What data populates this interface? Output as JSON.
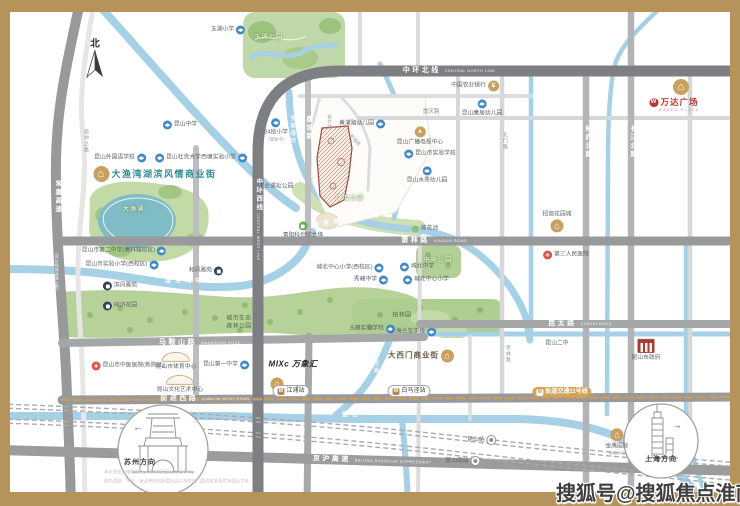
{
  "map": {
    "watermark": "搜狐号@搜狐焦点淮南站",
    "colors": {
      "frame_gold": "#b5935a",
      "ring_road": "#7e7f82",
      "road_gray": "#98999b",
      "road_light": "#bcbdbf",
      "river_blue": "#a6d0e6",
      "park_green": "#b9d49c",
      "lake_teal": "#7fbcc6",
      "poi_gold": "#c9a05e",
      "school_blue": "#4289c7",
      "hospital_red": "#d9534f",
      "residential_navy": "#33415c",
      "wanda_red": "#bf3330",
      "title_teal": "#2f8b94",
      "site_outline": "#a14a42",
      "metro_gold": "#c89c5e"
    },
    "labels": [
      {
        "t": "road",
        "n": "road-zhonghuan-north",
        "text": "中环北线",
        "sub": "CENTRAL NORTH LINE",
        "x": 449,
        "y": 71
      },
      {
        "t": "roadv",
        "n": "road-zhonghuan-west",
        "text": "中环西线",
        "x": 258,
        "y": 195
      },
      {
        "t": "roadv2",
        "n": "road-zhonghuan-west-en",
        "text": "CENTRAL WEST LINE",
        "x": 258,
        "y": 237
      },
      {
        "t": "road",
        "n": "road-xiaolin",
        "text": "萧林路",
        "sub": "XIAOLIN ROAD",
        "x": 434,
        "y": 241
      },
      {
        "t": "road",
        "n": "road-kuntai",
        "text": "昆太路",
        "sub": "KUNTAI ROAD",
        "x": 580,
        "y": 324
      },
      {
        "t": "road",
        "n": "road-maanshan",
        "text": "马鞍山路",
        "sub": "MAANSHAN ROAD",
        "x": 200,
        "y": 343
      },
      {
        "t": "road",
        "n": "road-qianjin-west",
        "text": "前进西路",
        "sub": "QIANJIN WEST ROAD",
        "x": 205,
        "y": 399
      },
      {
        "t": "road",
        "n": "road-jinghu-expressway",
        "text": "京沪高速",
        "sub": "BEIJING-SHANGHAI EXPRESSWAY",
        "x": 372,
        "y": 461,
        "rot": 1.6
      },
      {
        "t": "roadv",
        "n": "road-changjia-expressway",
        "text": "常嘉高速",
        "x": 57,
        "y": 197
      },
      {
        "t": "roadv2",
        "n": "road-changjia-sub",
        "text": "(苏州绕城高速公路)",
        "x": 57,
        "y": 272
      },
      {
        "t": "roadvg",
        "n": "road-zuchongzhi",
        "text": "祖冲之路",
        "x": 85,
        "y": 141
      },
      {
        "t": "roadv",
        "n": "road-lucheng",
        "text": "鹿城路",
        "x": 308,
        "y": 128
      },
      {
        "t": "roadv",
        "n": "road-bailu-north",
        "text": "柏庐北路",
        "x": 587,
        "y": 142
      },
      {
        "t": "roadv",
        "n": "road-changjiang-north",
        "text": "长江北路",
        "x": 632,
        "y": 142
      },
      {
        "t": "rdside",
        "n": "road-chongqing",
        "text": "重庆路",
        "x": 431,
        "y": 112
      },
      {
        "t": "roadvg",
        "n": "road-beimen",
        "text": "北门路",
        "x": 504,
        "y": 141
      },
      {
        "t": "roadvg",
        "n": "road-tinglin",
        "text": "亭林路",
        "x": 507,
        "y": 354
      },
      {
        "t": "riverv",
        "n": "river-zhangjiagang",
        "text": "张家港河",
        "x": 292,
        "y": 130
      },
      {
        "t": "river",
        "n": "river-eco-corridor",
        "text": "张家港河生态绿廊",
        "x": 353,
        "y": 220,
        "rot": -9
      },
      {
        "t": "river",
        "n": "river-miaojing-waterway",
        "text": "庙泾河中央水系",
        "x": 200,
        "y": 282
      },
      {
        "t": "river",
        "n": "river-loujiang",
        "text": "娄江",
        "x": 352,
        "y": 416
      },
      {
        "t": "riverv",
        "n": "river-qingyanggang",
        "text": "青阳港",
        "x": 375,
        "y": 364
      },
      {
        "t": "park",
        "n": "park-yuhu",
        "text": "玉湖公园",
        "x": 269,
        "y": 38
      },
      {
        "t": "park",
        "n": "lake-dayu",
        "text": "大渔湖",
        "x": 134,
        "y": 210
      },
      {
        "t": "parkd",
        "n": "park-forest-line1",
        "text": "城市生态",
        "x": 239,
        "y": 319
      },
      {
        "t": "parkd",
        "n": "park-forest-line2",
        "text": "森林公园",
        "x": 239,
        "y": 327
      },
      {
        "t": "park",
        "n": "park-central",
        "text": "中央公园",
        "x": 438,
        "y": 261
      },
      {
        "t": "parkd",
        "n": "park-bolin",
        "text": "柏林园",
        "x": 402,
        "y": 316
      },
      {
        "t": "park",
        "n": "park-guangdian",
        "text": "广电公园",
        "x": 350,
        "y": 199
      },
      {
        "t": "poi",
        "n": "poi-industrial-heritage-park",
        "text": "工业遗址公园",
        "x": 276,
        "y": 187
      },
      {
        "t": "poi",
        "n": "poi-lotus-pond",
        "text": "荷花池",
        "x": 425,
        "y": 229,
        "ic": "park-icon",
        "side": "b"
      },
      {
        "t": "title",
        "n": "title-dayuwan-street",
        "text": "大渔湾湖滨风情商业街",
        "x": 155,
        "y": 174,
        "ic": "gold-lg-icon",
        "side": "b"
      },
      {
        "t": "poi",
        "n": "poi-yuhu-primary",
        "text": "玉湖小学",
        "x": 228,
        "y": 30,
        "ic": "school-icon",
        "side": "a"
      },
      {
        "t": "poi",
        "n": "poi-kunshan-middle",
        "text": "昆山中学",
        "x": 180,
        "y": 125,
        "ic": "school-icon",
        "side": "b"
      },
      {
        "t": "poi",
        "n": "poi-foreign-language-school",
        "text": "昆山外国语学校",
        "x": 120,
        "y": 158,
        "ic": "school-icon",
        "side": "a"
      },
      {
        "t": "poi",
        "n": "poi-duke-kunshan-university",
        "text": "昆山杜克大学",
        "x": 178,
        "y": 158,
        "ic": "school-icon",
        "side": "b"
      },
      {
        "t": "poi",
        "n": "poi-xitang-experimental-primary",
        "text": "西塘实验小学",
        "x": 224,
        "y": 158,
        "ic": "school-icon",
        "side": "a"
      },
      {
        "t": "poist",
        "n": "poi-24class-primary",
        "text": "24班小学",
        "sub": "(规划中)",
        "x": 276,
        "y": 130,
        "ic": "school-icon"
      },
      {
        "t": "poi",
        "n": "poi-huangpu-kindergarten",
        "text": "黄浦路幼儿园",
        "x": 362,
        "y": 124,
        "ic": "school-icon",
        "side": "a"
      },
      {
        "t": "poi",
        "n": "poi-agricultural-bank",
        "text": "中国农业银行",
        "x": 475,
        "y": 86,
        "ic": "bank-icon",
        "side": "a"
      },
      {
        "t": "poist",
        "n": "poi-kangju-kindergarten",
        "text": "昆山康居幼儿园",
        "x": 482,
        "y": 108,
        "ic": "school-icon"
      },
      {
        "t": "poist",
        "n": "poi-broadcast-tv-center",
        "text": "昆山广播电视中心",
        "x": 420,
        "y": 136,
        "ic": "tower-gold-icon"
      },
      {
        "t": "poi",
        "n": "poi-kunshan-experimental-school",
        "text": "昆山市实验学校",
        "x": 430,
        "y": 154,
        "ic": "school-icon",
        "side": "b"
      },
      {
        "t": "poist",
        "n": "poi-shuixiu-kindergarten",
        "text": "昆山水秀幼儿园",
        "x": 427,
        "y": 175,
        "ic": "school-icon"
      },
      {
        "t": "poi",
        "n": "poi-chengbei-middle",
        "text": "城北中学",
        "x": 417,
        "y": 267,
        "ic": "school-icon",
        "side": "b"
      },
      {
        "t": "poi",
        "n": "poi-xiufeng-middle",
        "text": "秀峰中学",
        "x": 371,
        "y": 280,
        "ic": "school-icon",
        "side": "a"
      },
      {
        "t": "poi",
        "n": "poi-chengbei-central-primary",
        "text": "城北中心小学",
        "x": 426,
        "y": 280,
        "ic": "school-icon",
        "side": "b"
      },
      {
        "t": "poi",
        "n": "poi-chengbei-central-primary-west",
        "text": "城北中心小学(西校区)",
        "x": 350,
        "y": 268,
        "ic": "school-icon",
        "side": "a"
      },
      {
        "t": "poi",
        "n": "poi-yufeng-experimental-school",
        "text": "玉峰实验学校",
        "x": 372,
        "y": 329,
        "ic": "school-icon",
        "side": "a"
      },
      {
        "t": "poi",
        "n": "poi-no2-middle-xiaolin-campus",
        "text": "昆山市第二中学(萧林路校区)",
        "x": 124,
        "y": 251,
        "ic": "school-icon",
        "side": "a"
      },
      {
        "t": "poi",
        "n": "poi-experimental-primary-west-campus",
        "text": "昆山市实验小学(西校区)",
        "x": 122,
        "y": 265,
        "ic": "school-icon",
        "side": "a"
      },
      {
        "t": "poi",
        "n": "poi-hefeng-yayuan",
        "text": "和风雅苑",
        "x": 206,
        "y": 271,
        "ic": "res-icon",
        "side": "a"
      },
      {
        "t": "poi",
        "n": "poi-binfeng-yayuan",
        "text": "滨风雅苑",
        "x": 120,
        "y": 286,
        "ic": "res-icon",
        "side": "b"
      },
      {
        "t": "poi",
        "n": "poi-tongji-garden",
        "text": "同济花园",
        "x": 120,
        "y": 306,
        "ic": "res-icon",
        "side": "b"
      },
      {
        "t": "poist",
        "n": "poi-qingyang-tech-complex",
        "text": "青阳科创综合体",
        "x": 303,
        "y": 230,
        "ic": "green-icon"
      },
      {
        "t": "poi",
        "n": "poi-shanghai-lansheng-school",
        "text": "上海兰生学校",
        "x": 413,
        "y": 332,
        "ic": "school-icon",
        "side": "a"
      },
      {
        "t": "poi",
        "n": "poi-tcm-hospital-new-campus",
        "text": "昆山市中医医院(新院区)",
        "x": 128,
        "y": 366,
        "ic": "hospital-icon",
        "side": "b"
      },
      {
        "t": "poi",
        "n": "poi-third-peoples-hospital",
        "text": "第三人民医院",
        "x": 566,
        "y": 255,
        "ic": "hospital-icon",
        "side": "b"
      },
      {
        "t": "poisk",
        "n": "poi-sports-center",
        "text": "昆山市体育中心",
        "x": 176,
        "y": 361,
        "sk": true
      },
      {
        "t": "poisk",
        "n": "poi-culture-art-center",
        "text": "昆山文化艺术中心",
        "x": 180,
        "y": 384,
        "sk": true
      },
      {
        "t": "poi",
        "n": "poi-no1-middle-school",
        "text": "昆山第一中学",
        "x": 226,
        "y": 365,
        "ic": "school-icon",
        "side": "a"
      },
      {
        "t": "mixc",
        "n": "poi-mixc-logo",
        "text": "MIXc 万象汇",
        "x": 293,
        "y": 364
      },
      {
        "t": "iconly",
        "n": "poi-mixc-mall-icon",
        "x": 277,
        "y": 384,
        "ic": "shop-gold-icon"
      },
      {
        "t": "poilg",
        "n": "poi-daximen-commercial-street",
        "text": "大西门商业街",
        "x": 421,
        "y": 356,
        "ic": "shop-gold-icon",
        "side": "a"
      },
      {
        "t": "poistb",
        "n": "poi-cmsk-garden-city",
        "text": "招商花园城",
        "x": 557,
        "y": 222,
        "ic": "shop-gold-icon",
        "side": "a"
      },
      {
        "t": "poist",
        "n": "poi-golden-eagle-mall",
        "text": "金鹰国际",
        "sub": "购物中心",
        "x": 617,
        "y": 442,
        "ic": "shop-gold-icon"
      },
      {
        "t": "poist",
        "n": "poi-city-government",
        "text": "昆山市政府",
        "x": 646,
        "y": 350,
        "ic": "govt-icon"
      },
      {
        "t": "poi",
        "n": "poi-kunshan-no2-middle",
        "text": "昆山二中",
        "x": 557,
        "y": 344
      },
      {
        "t": "badge",
        "n": "station-jiangpu",
        "text": "江浦站",
        "x": 291,
        "y": 391,
        "ic": "metro-icon",
        "side": "b"
      },
      {
        "t": "badge",
        "n": "station-baimajing",
        "text": "白马泾站",
        "x": 409,
        "y": 391,
        "ic": "metro-icon",
        "side": "b"
      },
      {
        "t": "badgegold",
        "n": "badge-metro-line-11",
        "text": "轨道交通11号线",
        "x": 562,
        "y": 392,
        "ic": "metro-white-icon",
        "side": "b"
      },
      {
        "t": "poi",
        "n": "station-kunshan",
        "text": "昆山站",
        "x": 482,
        "y": 440,
        "ic": "train-icon",
        "side": "a"
      },
      {
        "t": "poi",
        "n": "station-kunshan-south",
        "text": "昆山南站",
        "x": 463,
        "y": 461,
        "ic": "train-icon",
        "side": "a"
      },
      {
        "t": "dir",
        "n": "direction-suzhou",
        "text": "苏州方向",
        "x": 140,
        "y": 463
      },
      {
        "t": "dir",
        "n": "direction-shanghai",
        "text": "上海方向",
        "x": 661,
        "y": 460
      },
      {
        "t": "arrow",
        "n": "arrow-west",
        "text": "←",
        "x": 138,
        "y": 428
      },
      {
        "t": "arrow",
        "n": "arrow-east",
        "text": "→",
        "x": 677,
        "y": 426
      },
      {
        "t": "north",
        "n": "compass-north-label",
        "text": "北",
        "x": 95,
        "y": 45
      },
      {
        "t": "streetv",
        "n": "street-zizhu",
        "text": "紫竹路",
        "x": 330,
        "y": 122
      },
      {
        "t": "street",
        "n": "street-xincheng",
        "text": "新城路",
        "x": 355,
        "y": 140,
        "rot": 48
      },
      {
        "t": "wandatx",
        "n": "poi-wanda-plaza",
        "text": "万达广场",
        "x": 674,
        "y": 103,
        "ic": "wanda-icon",
        "side": "b"
      },
      {
        "t": "wandasub",
        "n": "poi-wanda-plaza-en",
        "text": "WANDA PLAZA",
        "x": 679,
        "y": 110
      },
      {
        "t": "iconly",
        "n": "poi-wanda-gold-icon",
        "x": 681,
        "y": 87,
        "ic": "gold-lg-icon"
      },
      {
        "t": "tinyl",
        "n": "disclaimer-line-1",
        "text": "本示意图非精确测绘，仅作项目区位示意参考。",
        "x": 104,
        "y": 472
      },
      {
        "t": "tinyl",
        "n": "disclaimer-line-2",
        "text": "图中道路、学校、商业等规划配套信息以政府部门最终批复及实际建设为准。",
        "x": 104,
        "y": 481
      }
    ]
  }
}
